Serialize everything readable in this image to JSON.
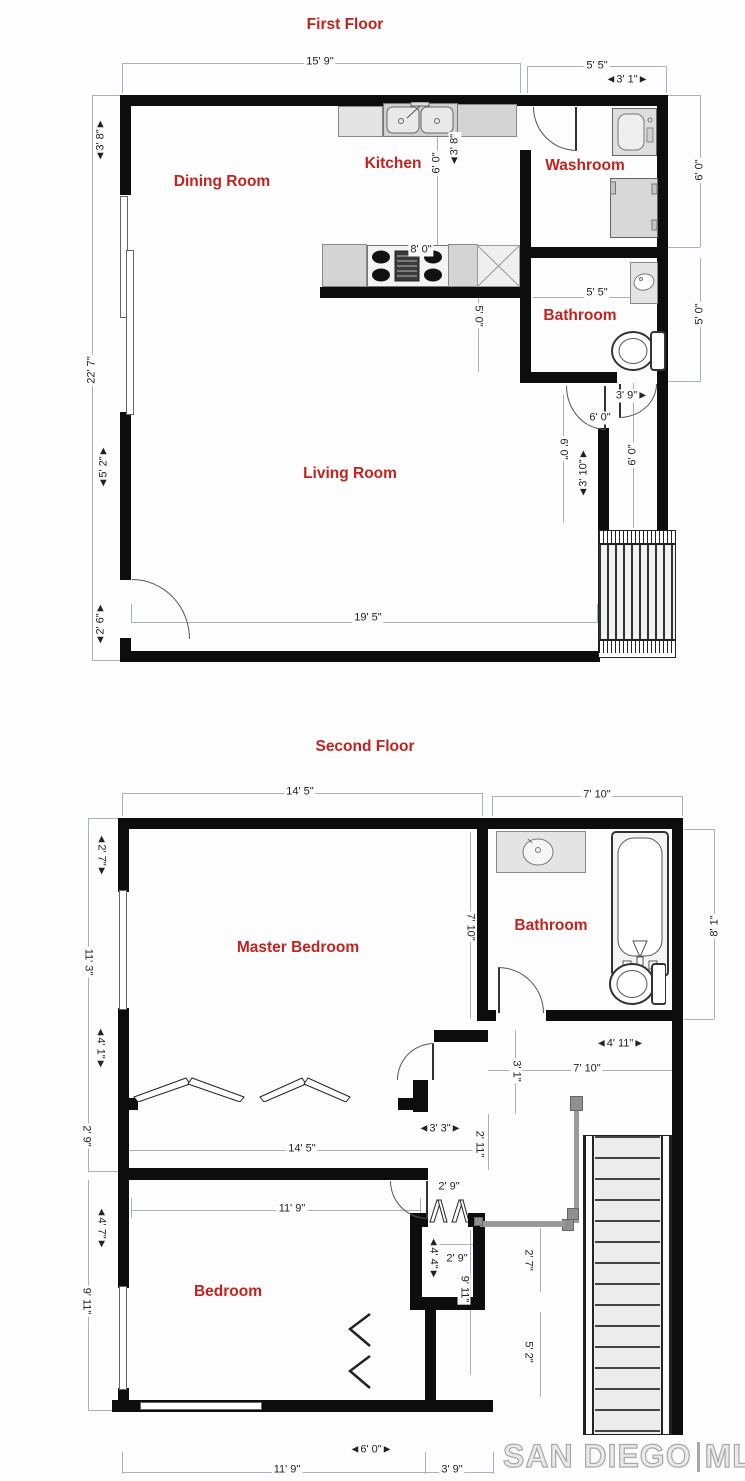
{
  "colors": {
    "wall": "#0d0d0d",
    "label_red": "#c3231e",
    "dim_text": "#222222",
    "dim_line": "#aab0c4",
    "watermark_gray": "#a8a8a8"
  },
  "first": {
    "title": "First Floor",
    "rooms": {
      "dining": "Dining Room",
      "kitchen": "Kitchen",
      "washroom": "Washroom",
      "bathroom": "Bathroom",
      "living": "Living Room"
    },
    "dims": {
      "top_width": "15' 9\"",
      "top_right": "5' 5\"",
      "door_3_1": "◄3' 1\"►",
      "left_3_8": "◄3' 8\"►",
      "left_total": "22' 7\"",
      "left_5_2": "◄5' 2\"►",
      "left_2_6": "◄2' 6\"►",
      "kitchen_6_0": "6' 0\"",
      "kitchen_3_8": "◄3' 8\"",
      "stove_8_0": "8' 0\"",
      "kitchen_5_0": "5' 0\"",
      "washroom_right_6_0": "6' 0\"",
      "bathroom_right_5_0": "5' 0\"",
      "bathroom_5_5": "5' 5\"",
      "hall_3_9": "3' 9\"►",
      "hall_6_0": "6' 0\"",
      "hall_6_0b": "6' 0\"",
      "hall_3_10": "◄3' 10\"►",
      "corridor_6_0": "6' 0\"",
      "living_19_5": "19' 5\""
    }
  },
  "second": {
    "title": "Second Floor",
    "rooms": {
      "master": "Master Bedroom",
      "bathroom": "Bathroom",
      "bedroom": "Bedroom"
    },
    "dims": {
      "top_14_5": "14' 5\"",
      "top_7_10": "7' 10\"",
      "left_2_7": "◄2' 7\"►",
      "left_11_3": "11' 3\"",
      "left_4_1": "◄4' 1\"►",
      "left_2_9": "2' 9\"",
      "left_4_7": "◄4' 7\"►",
      "left_9_11": "9' 11\"",
      "mb_7_10": "7' 10\"",
      "right_8_1": "8' 1\"",
      "hall_4_11": "◄4' 11\"►",
      "hall_7_10": "7' 10\"",
      "hall_3_1": "3' 1\"",
      "closet_14_5": "14' 5\"",
      "hall_3_3": "◄3' 3\"►",
      "hall_2_11": "2' 11\"",
      "bedroom_11_9": "11' 9\"",
      "hall_2_9": "2' 9\"",
      "closet_2_9": "2' 9\"",
      "closet_4_4": "◄4' 4\"►",
      "closet_9_11": "9' 11\"",
      "stair_2_7": "2' 7\"",
      "stair_5_2": "5' 2\"",
      "bottom_6_0": "◄6' 0\"►",
      "bottom_11_9": "11' 9\"",
      "bottom_3_9": "3' 9\""
    }
  },
  "watermark": {
    "name": "SAN DIEGO",
    "separator": "|",
    "mls": "MLS"
  }
}
